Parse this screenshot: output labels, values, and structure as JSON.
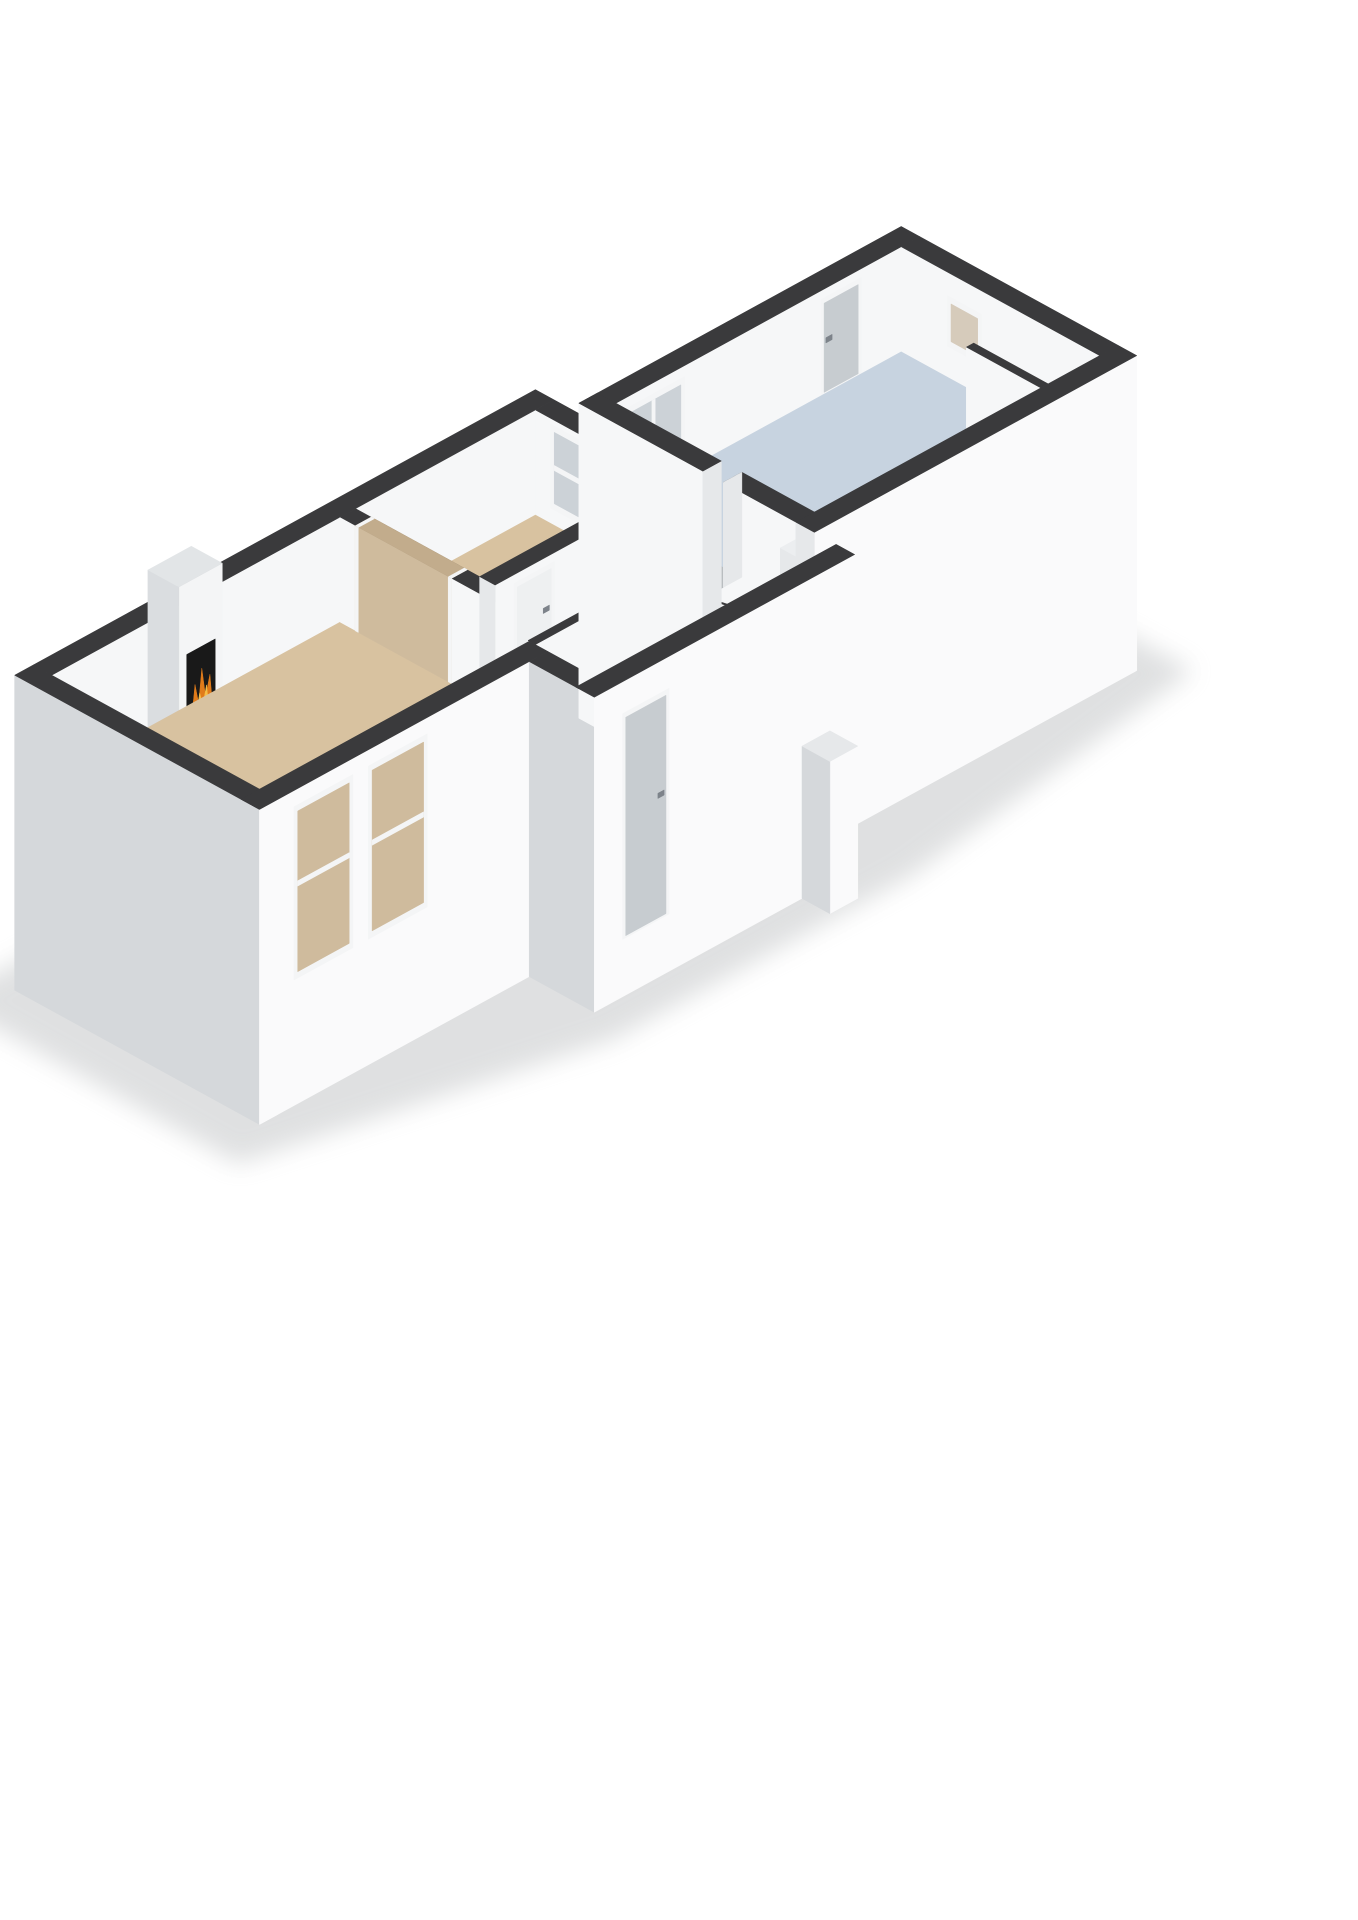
{
  "view": {
    "kind": "isometric-3d-floorplan-render",
    "background": "#ffffff"
  },
  "colors": {
    "shadow": "#b9bcbe",
    "wallTop": "#3a3a3c",
    "wallWhite": "#f6f7f8",
    "extBright": "#fafafb",
    "wallGrayW": "#d5d8db",
    "capLight": "#e6e8ea",
    "wallShadeW": "#cfd3d6",
    "floorTan": "#d8c2a0",
    "floorGray": "#b9bdc0",
    "floorWhite": "#f1f2f3",
    "floorBlue": "#c7d3e0",
    "hallFloor": "#eef0f1",
    "stair": "#dcab63",
    "stairLine": "#f1e3c9",
    "frame": "#f4f5f6",
    "doorLeaf": "#c7ccd0",
    "doorWhite": "#eef0f1",
    "handle": "#7d838a",
    "glass": "#ccd2d7",
    "tanThrough": "#cfbb9d",
    "tanThroughDark": "#c2ac8c",
    "corridorThrough": "#c2c6c9",
    "tanGlass": "#d6cbbb",
    "fpFace": "#f4f5f6",
    "fpTop": "#e2e5e7",
    "fpSide": "#dadde0",
    "stoveBlack": "#191919",
    "fire1": "#e07b1a",
    "fire2": "#f6bd45",
    "log": "#342518",
    "counterTop": "#eceef0"
  },
  "rooms": [
    {
      "name": "living-room",
      "floor": "floorTan",
      "features": [
        "fireplace-stove",
        "wide-wall-opening",
        "two-front-windows"
      ]
    },
    {
      "name": "bedroom",
      "floor": "floorTan",
      "features": [
        "window",
        "double-doors"
      ]
    },
    {
      "name": "corridor",
      "floor": "floorGray",
      "features": [
        "doors-to-rooms"
      ]
    },
    {
      "name": "toilet",
      "floor": "floorWhite",
      "features": [
        "open-door-leaf"
      ]
    },
    {
      "name": "closet",
      "floor": "floorWhite",
      "features": [
        "open-door-leaf"
      ]
    },
    {
      "name": "entrance-hall",
      "floor": "hallFloor",
      "features": [
        "entry-door",
        "staircase"
      ]
    },
    {
      "name": "bathroom",
      "floor": "floorBlue",
      "features": [
        "window",
        "back-door",
        "small-window",
        "counter",
        "partition"
      ]
    }
  ],
  "scene": [
    {
      "t": "poly",
      "name": "ground-shadow",
      "fill": "shadow",
      "op": 0.45,
      "blur": true,
      "pts": [
        [
          -0.7,
          5.1,
          -2
        ],
        [
          8.8,
          5.1,
          -2
        ],
        [
          8.9,
          4.5,
          -2
        ],
        [
          14.2,
          4.5,
          -2
        ],
        [
          14.2,
          -0.1,
          -2
        ],
        [
          8.9,
          -0.85,
          -2
        ],
        [
          4.1,
          -0.85,
          -2
        ],
        [
          -0.75,
          0.35,
          -2
        ]
      ]
    },
    {
      "t": "wallX",
      "name": "living-back-wall",
      "x0": 0.3,
      "x1": 8.4,
      "y": 4.4,
      "th": 0.3,
      "z0": 0,
      "z1": 1,
      "fill": "wallWhite",
      "top": "wallTop"
    },
    {
      "t": "wallX",
      "name": "fireplace-column",
      "x0": 1.85,
      "x1": 2.55,
      "y": 3.9,
      "th": 0.5,
      "z0": 0,
      "z1": 1.5,
      "fill": "fpFace",
      "top": "fpTop",
      "cap": true,
      "capFill": "fpSide",
      "feats": [
        {
          "k": "panel",
          "u": [
            1.97,
            2.43
          ],
          "z": [
            0.1,
            0.82
          ],
          "fill": "stoveBlack"
        }
      ]
    },
    {
      "t": "poly",
      "name": "fireplace-flame-outer",
      "fill": "fire1",
      "pts": [
        [
          2.03,
          3.88,
          0.16
        ],
        [
          2.09,
          3.88,
          0.5
        ],
        [
          2.15,
          3.88,
          0.3
        ],
        [
          2.2,
          3.88,
          0.62
        ],
        [
          2.26,
          3.88,
          0.33
        ],
        [
          2.33,
          3.88,
          0.52
        ],
        [
          2.38,
          3.88,
          0.16
        ]
      ]
    },
    {
      "t": "poly",
      "name": "fireplace-flame-inner",
      "fill": "fire2",
      "pts": [
        [
          2.09,
          3.875,
          0.16
        ],
        [
          2.16,
          3.875,
          0.4
        ],
        [
          2.21,
          3.875,
          0.26
        ],
        [
          2.27,
          3.875,
          0.44
        ],
        [
          2.32,
          3.875,
          0.16
        ]
      ]
    },
    {
      "t": "poly",
      "name": "fireplace-log",
      "fill": "log",
      "pts": [
        [
          1.99,
          3.878,
          0.11
        ],
        [
          2.41,
          3.878,
          0.11
        ],
        [
          2.41,
          3.878,
          0.19
        ],
        [
          1.99,
          3.878,
          0.19
        ]
      ]
    },
    {
      "t": "wallY",
      "name": "bedroom-east-wall",
      "x": 8.1,
      "th": 0.3,
      "y0": 0.95,
      "y1": 4.4,
      "z0": 0,
      "z1": 1,
      "fill": "wallWhite",
      "top": "wallTop",
      "cap": true,
      "capFill": "capLight",
      "feats": [
        {
          "k": "open",
          "u": [
            1.82,
            2.15
          ],
          "z": [
            0,
            1
          ],
          "through": "corridorThrough",
          "fullTop": true
        },
        {
          "k": "dbl",
          "u": [
            2.5,
            3.45
          ],
          "z": [
            0,
            0.92
          ]
        },
        {
          "k": "win",
          "u": [
            3.5,
            4.15
          ],
          "z": [
            0.15,
            0.95
          ],
          "glass": "glass",
          "mull": "h",
          "mz": 0.55
        }
      ]
    },
    {
      "t": "poly",
      "name": "living-room-floor",
      "fill": "floorTan",
      "pts": [
        [
          0.3,
          1.05
        ],
        [
          4.95,
          1.05
        ],
        [
          4.95,
          4.4
        ],
        [
          0.3,
          4.4
        ]
      ]
    },
    {
      "t": "poly",
      "name": "bedroom-floor",
      "fill": "floorTan",
      "pts": [
        [
          5.2,
          2.4
        ],
        [
          8.1,
          2.4
        ],
        [
          8.1,
          4.4
        ],
        [
          5.2,
          4.4
        ]
      ]
    },
    {
      "t": "poly",
      "name": "corridor-floor",
      "fill": "floorGray",
      "pts": [
        [
          5.2,
          1.07
        ],
        [
          6.3,
          1.07
        ],
        [
          6.3,
          1.82
        ],
        [
          8.85,
          1.82
        ],
        [
          8.85,
          2.15
        ],
        [
          5.2,
          2.15
        ]
      ]
    },
    {
      "t": "poly",
      "name": "toilet-floor",
      "fill": "floorWhite",
      "pts": [
        [
          6.3,
          0.95
        ],
        [
          7.5,
          0.95
        ],
        [
          7.5,
          1.7
        ],
        [
          6.3,
          1.7
        ]
      ]
    },
    {
      "t": "poly",
      "name": "closet-floor",
      "fill": "floorWhite",
      "pts": [
        [
          7.5,
          0.95
        ],
        [
          8.1,
          0.95
        ],
        [
          8.1,
          1.7
        ],
        [
          7.5,
          1.7
        ]
      ]
    },
    {
      "t": "poly",
      "name": "hall-floor",
      "fill": "hallFloor",
      "pts": [
        [
          4.65,
          0
        ],
        [
          8.45,
          0
        ],
        [
          8.45,
          0.83
        ],
        [
          4.65,
          0.83
        ]
      ]
    },
    {
      "t": "wallY",
      "name": "living-east-wall",
      "x": 4.95,
      "th": 0.25,
      "y0": 1.05,
      "y1": 4.4,
      "z0": 0,
      "z1": 1,
      "fill": "wallWhite",
      "top": "wallTop",
      "cap": true,
      "capFill": "capLight",
      "feats": [
        {
          "k": "open",
          "u": [
            2.6,
            4.15
          ],
          "z": [
            0,
            1
          ],
          "through": "tanThrough",
          "throughTop": "tanThroughDark",
          "fullTop": true
        }
      ]
    },
    {
      "t": "wallX",
      "name": "bedroom-front-wall",
      "x0": 5.2,
      "x1": 8.1,
      "y": 2.15,
      "th": 0.25,
      "z0": 0,
      "z1": 1,
      "fill": "wallWhite",
      "top": "wallTop",
      "cap": true,
      "capFill": "capLight",
      "feats": [
        {
          "k": "door",
          "u": [
            5.5,
            6.15
          ],
          "z": [
            0,
            0.92
          ],
          "hs": 1,
          "leaf": "doorWhite"
        }
      ]
    },
    {
      "t": "wallX",
      "name": "toilet-north-wall",
      "x0": 6.3,
      "x1": 8.1,
      "y": 1.7,
      "th": 0.12,
      "z0": 0,
      "z1": 1,
      "fill": "wallWhite",
      "top": "wallTop",
      "feats": [
        {
          "k": "open",
          "u": [
            6.55,
            7.15
          ],
          "z": [
            0,
            0.92
          ],
          "through": "floorWhite"
        },
        {
          "k": "open",
          "u": [
            7.72,
            8.0
          ],
          "z": [
            0,
            0.92
          ],
          "through": "floorWhite"
        }
      ]
    },
    {
      "t": "wallY",
      "name": "toilet-west-wall",
      "x": 6.3,
      "th": 0.12,
      "y0": 0.95,
      "y1": 1.7,
      "z0": 0,
      "z1": 1,
      "fill": "wallShadeW",
      "top": "wallTop"
    },
    {
      "t": "wallY",
      "name": "toilet-closet-divider",
      "x": 7.5,
      "th": 0.12,
      "y0": 0.95,
      "y1": 1.7,
      "z0": 0,
      "z1": 1,
      "fill": "wallShadeW",
      "top": "wallTop",
      "cap": true,
      "capFill": "capLight"
    },
    {
      "t": "poly",
      "name": "toilet-door-leaf",
      "fill": "frame",
      "stroke": "#c6cbce",
      "pts": [
        [
          6.62,
          1.7,
          0
        ],
        [
          6.62,
          1.32,
          0
        ],
        [
          6.62,
          1.32,
          0.9
        ],
        [
          6.62,
          1.7,
          0.9
        ]
      ]
    },
    {
      "t": "poly",
      "name": "closet-door-leaf",
      "fill": "frame",
      "stroke": "#c6cbce",
      "pts": [
        [
          7.86,
          1.7,
          0
        ],
        [
          7.86,
          1.34,
          0
        ],
        [
          7.86,
          1.34,
          0.9
        ],
        [
          7.86,
          1.7,
          0.9
        ]
      ]
    },
    {
      "t": "wallX",
      "name": "hall-back-wall",
      "x0": 4.65,
      "x1": 6.55,
      "y": 0.95,
      "th": 0.12,
      "z0": 0,
      "z1": 1,
      "fill": "wallWhite",
      "top": "wallTop",
      "feats": [
        {
          "k": "door",
          "u": [
            5.5,
            6.12
          ],
          "z": [
            0,
            0.92
          ],
          "hs": 1,
          "leaf": "doorWhite"
        }
      ]
    },
    {
      "t": "poly",
      "name": "staircase-wall",
      "fill": "wallWhite",
      "pts": [
        [
          6.55,
          0.83,
          0
        ],
        [
          8.45,
          0.83,
          0
        ],
        [
          8.45,
          0.83,
          0.02
        ],
        [
          6.55,
          0.83,
          1.0
        ]
      ]
    },
    {
      "t": "poly",
      "name": "staircase-wall-top",
      "fill": "wallTop",
      "pts": [
        [
          6.55,
          0.83,
          1.0
        ],
        [
          8.45,
          0.83,
          0.02
        ],
        [
          8.45,
          0.95,
          0.02
        ],
        [
          6.55,
          0.95,
          1.0
        ]
      ]
    },
    {
      "t": "poly",
      "name": "staircase-flight",
      "fill": "stair",
      "pts": [
        [
          6.55,
          0,
          0.8
        ],
        [
          6.55,
          0.83,
          0.8
        ],
        [
          8.45,
          0.83,
          -0.57
        ],
        [
          8.45,
          0,
          -0.57
        ]
      ]
    },
    {
      "t": "poly",
      "name": "stair-step",
      "fill": "stairLine",
      "pts": [
        [
          6.55,
          0,
          0.8
        ],
        [
          6.55,
          0.83,
          0.8
        ],
        [
          6.6,
          0.83,
          0.764
        ],
        [
          6.6,
          0,
          0.764
        ]
      ]
    },
    {
      "t": "poly",
      "name": "stair-step",
      "fill": "stairLine",
      "pts": [
        [
          6.95,
          0,
          0.512
        ],
        [
          6.95,
          0.83,
          0.512
        ],
        [
          7.0,
          0.83,
          0.476
        ],
        [
          7.0,
          0,
          0.476
        ]
      ]
    },
    {
      "t": "poly",
      "name": "stair-step",
      "fill": "stairLine",
      "pts": [
        [
          7.35,
          0,
          0.223
        ],
        [
          7.35,
          0.83,
          0.223
        ],
        [
          7.4,
          0.83,
          0.187
        ],
        [
          7.4,
          0,
          0.187
        ]
      ]
    },
    {
      "t": "poly",
      "name": "stair-step",
      "fill": "stairLine",
      "pts": [
        [
          7.75,
          0,
          -0.065
        ],
        [
          7.75,
          0.83,
          -0.065
        ],
        [
          7.8,
          0.83,
          -0.101
        ],
        [
          7.8,
          0,
          -0.101
        ]
      ]
    },
    {
      "t": "poly",
      "name": "stair-step",
      "fill": "stairLine",
      "pts": [
        [
          8.15,
          0,
          -0.354
        ],
        [
          8.15,
          0.83,
          -0.354
        ],
        [
          8.2,
          0.83,
          -0.39
        ],
        [
          8.2,
          0,
          -0.39
        ]
      ]
    },
    {
      "t": "wallY",
      "name": "left-end-wall",
      "x": 0,
      "th": 0.3,
      "y0": 0.75,
      "y1": 4.7,
      "z0": -2,
      "z1": 1,
      "fill": "wallGrayW",
      "top": "wallTop",
      "cap": true,
      "capFill": "extBright"
    },
    {
      "t": "wallX",
      "name": "living-front-wall",
      "x0": 0,
      "x1": 4.65,
      "y": 0.75,
      "th": 0.3,
      "z0": -2,
      "z1": 1,
      "fill": "extBright",
      "top": "wallTop",
      "feats": [
        {
          "k": "win",
          "u": [
            0.55,
            1.5
          ],
          "z": [
            -0.8,
            0.85
          ],
          "glass": "tanThrough",
          "mull": "h",
          "mz": 0.1
        },
        {
          "k": "win",
          "u": [
            1.75,
            2.7
          ],
          "z": [
            -0.8,
            0.85
          ],
          "glass": "tanThrough",
          "mull": "h",
          "mz": 0.1
        }
      ]
    },
    {
      "t": "wallY",
      "name": "entry-recess-wall",
      "x": 4.35,
      "th": 0.3,
      "y0": -0.3,
      "y1": 0.75,
      "z0": -2,
      "z1": 1,
      "fill": "wallGrayW",
      "top": "wallTop"
    },
    {
      "t": "wallX",
      "name": "kitchen-back-wall",
      "x0": 8.55,
      "x1": 13.75,
      "y": 3.85,
      "th": 0.3,
      "z0": 0,
      "z1": 1,
      "fill": "wallWhite",
      "top": "wallTop",
      "feats": [
        {
          "k": "win",
          "u": [
            8.95,
            9.95
          ],
          "z": [
            0.12,
            0.9
          ],
          "glass": "glass",
          "mull": "v"
        },
        {
          "k": "door",
          "u": [
            12.15,
            12.8
          ],
          "z": [
            0,
            0.92
          ],
          "hs": -1
        }
      ]
    },
    {
      "t": "wallY",
      "name": "kitchen-east-wall",
      "x": 13.45,
      "th": 0.3,
      "y0": 0.65,
      "y1": 3.85,
      "z0": 0,
      "z1": 1,
      "fill": "wallWhite",
      "top": "wallTop",
      "feats": [
        {
          "k": "win",
          "u": [
            2.55,
            3.1
          ],
          "z": [
            0.3,
            0.78
          ],
          "glass": "tanGlass"
        }
      ]
    },
    {
      "t": "poly",
      "name": "bathroom-floor",
      "fill": "floorBlue",
      "pts": [
        [
          8.85,
          0.65
        ],
        [
          13.45,
          0.65
        ],
        [
          13.45,
          3.85
        ],
        [
          8.85,
          3.85
        ]
      ]
    },
    {
      "t": "wallY",
      "name": "kitchen-west-wall-back",
      "x": 8.55,
      "th": 0.3,
      "y0": 2.15,
      "y1": 4.15,
      "z0": -2,
      "z1": 1,
      "fill": "wallWhite",
      "top": "wallTop",
      "cap": true,
      "capFill": "capLight"
    },
    {
      "t": "wallY",
      "name": "kitchen-west-wall-front",
      "x": 8.55,
      "th": 0.3,
      "y0": 0.35,
      "y1": 1.82,
      "z0": 0,
      "z1": 1,
      "fill": "wallWhite",
      "top": "wallTop"
    },
    {
      "t": "poly",
      "name": "kitchen-opening-jamb",
      "fill": "capLight",
      "pts": [
        [
          8.55,
          1.82,
          0
        ],
        [
          8.85,
          1.82,
          0
        ],
        [
          8.85,
          1.82,
          1
        ],
        [
          8.55,
          1.82,
          1
        ]
      ]
    },
    {
      "t": "poly",
      "name": "counter-side",
      "fill": "capLight",
      "pts": [
        [
          8.85,
          0.65,
          0
        ],
        [
          8.85,
          1.2,
          0
        ],
        [
          8.85,
          1.2,
          0.48
        ],
        [
          8.85,
          0.65,
          0.48
        ]
      ]
    },
    {
      "t": "poly",
      "name": "counter-top",
      "fill": "counterTop",
      "pts": [
        [
          8.85,
          0.65,
          0.48
        ],
        [
          13.45,
          0.65,
          0.48
        ],
        [
          13.45,
          1.2,
          0.48
        ],
        [
          8.85,
          1.2,
          0.48
        ]
      ]
    },
    {
      "t": "wallY",
      "name": "bathroom-partition",
      "x": 12.5,
      "th": 0.12,
      "y0": 0.65,
      "y1": 1.85,
      "z0": 0,
      "z1": 1,
      "fill": "wallWhite",
      "top": "wallTop",
      "cap": true,
      "capFill": "capLight"
    },
    {
      "t": "wallX",
      "name": "kitchen-front-wall",
      "x0": 8.55,
      "x1": 13.75,
      "y": 0.35,
      "th": 0.3,
      "z0": -2,
      "z1": 1,
      "fill": "extBright",
      "top": "wallTop",
      "cap": true,
      "capFill": "capLight"
    },
    {
      "t": "wallX",
      "name": "hall-front-wall",
      "x0": 4.35,
      "x1": 8.55,
      "y": -0.3,
      "th": 0.3,
      "z0": -2,
      "z1": 1,
      "fill": "extBright",
      "top": "wallTop",
      "feats": [
        {
          "k": "door",
          "u": [
            4.8,
            5.55
          ],
          "z": [
            -1.45,
            0.7
          ],
          "hs": 1
        }
      ]
    },
    {
      "t": "wallX",
      "name": "exterior-utility-box",
      "x0": 7.7,
      "x1": 8.15,
      "y": -0.75,
      "th": 0.45,
      "z0": -2,
      "z1": -0.55,
      "fill": "extBright",
      "top": "capLight",
      "cap": true,
      "capFill": "wallGrayW"
    }
  ]
}
